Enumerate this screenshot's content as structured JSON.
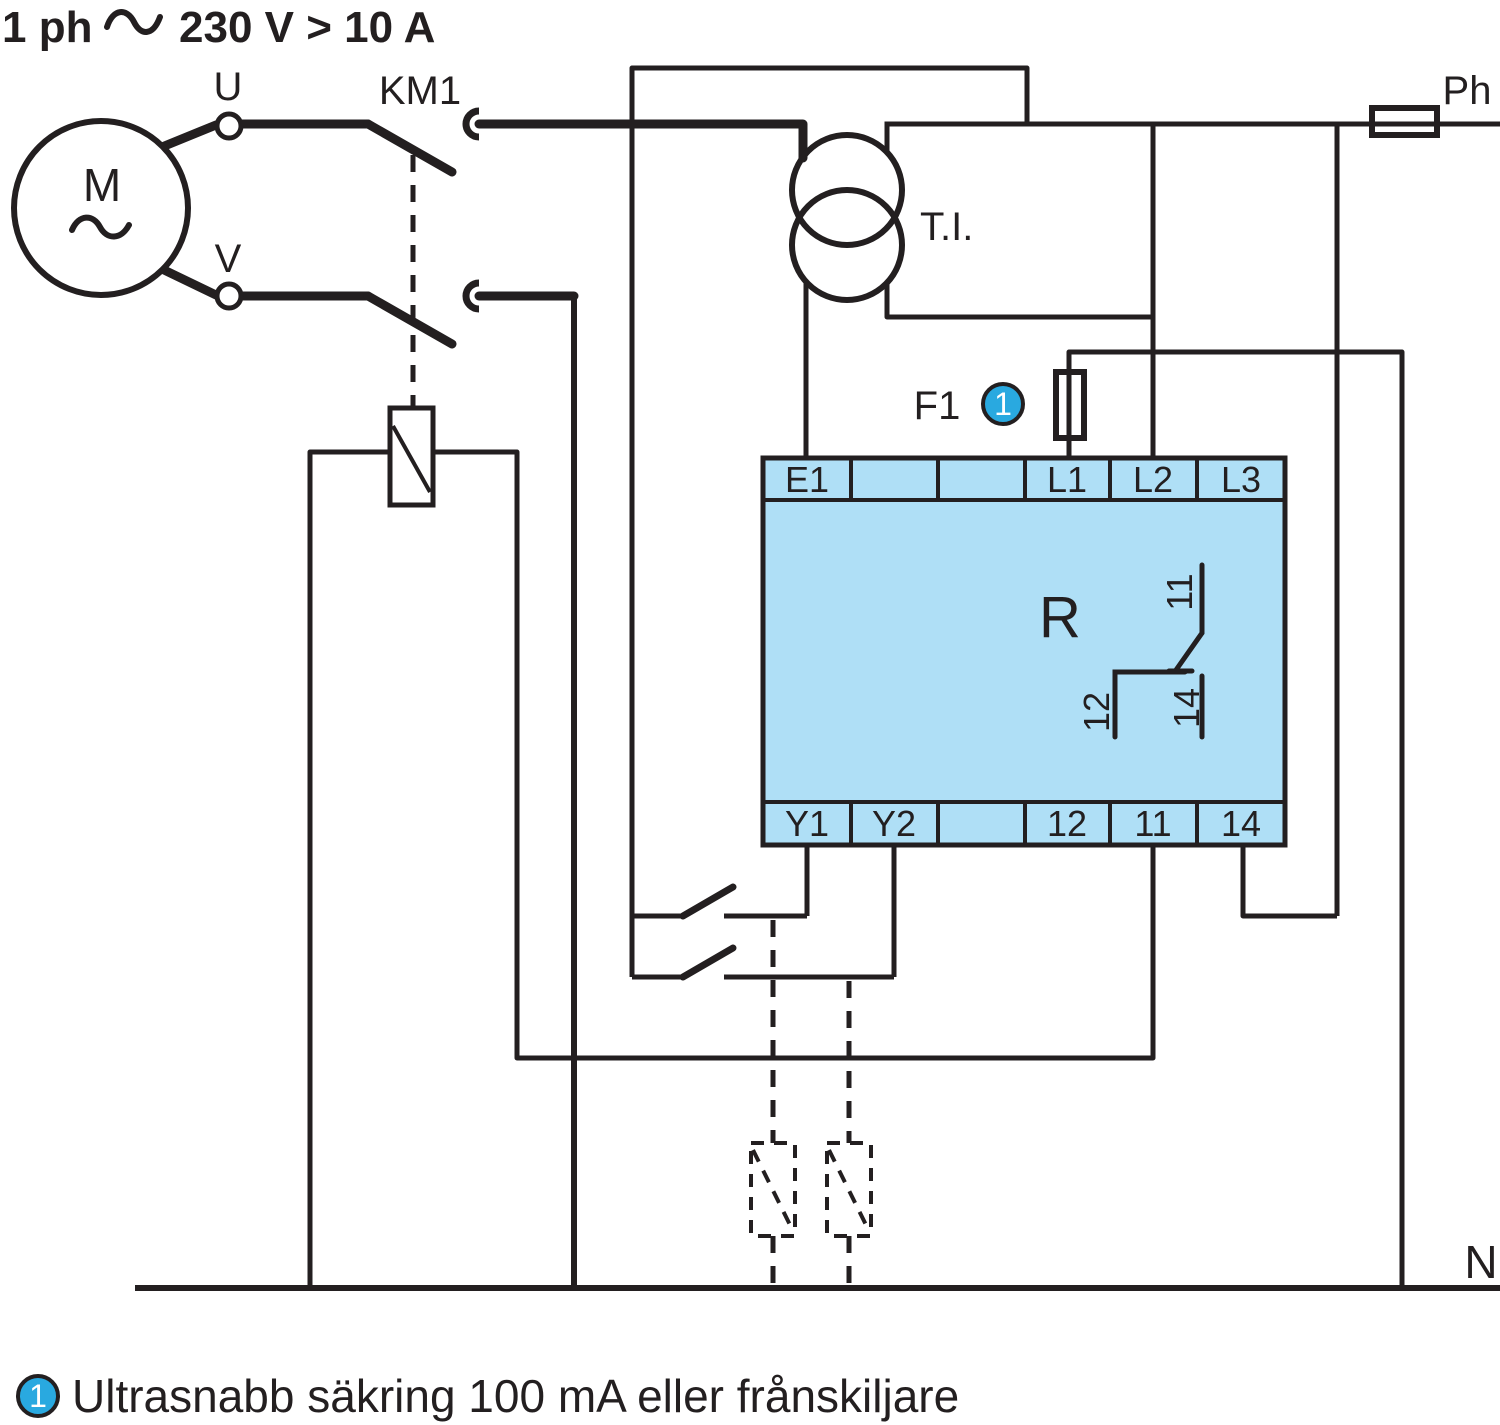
{
  "title": {
    "prefix": "1 ph",
    "suffix": "230 V > 10 A"
  },
  "labels": {
    "motor": "M",
    "terminal_u": "U",
    "terminal_v": "V",
    "contactor": "KM1",
    "current_transformer": "T.I.",
    "fuse": "F1",
    "phase": "Ph",
    "neutral": "N"
  },
  "relay": {
    "name": "R",
    "top_terminals": [
      "E1",
      "",
      "",
      "L1",
      "L2",
      "L3"
    ],
    "bottom_terminals": [
      "Y1",
      "Y2",
      "",
      "12",
      "11",
      "14"
    ],
    "contact": {
      "common": "11",
      "nc": "12",
      "no": "14"
    },
    "body_color": "#AFDFF6"
  },
  "badge": {
    "number": "1",
    "color": "#29A9E0"
  },
  "footnote": {
    "marker": "1",
    "text": "Ultrasnabb säkring 100 mA eller frånskiljare"
  },
  "colors": {
    "line": "#231F20",
    "relay_fill": "#AFDFF6",
    "badge_blue": "#29A9E0"
  }
}
